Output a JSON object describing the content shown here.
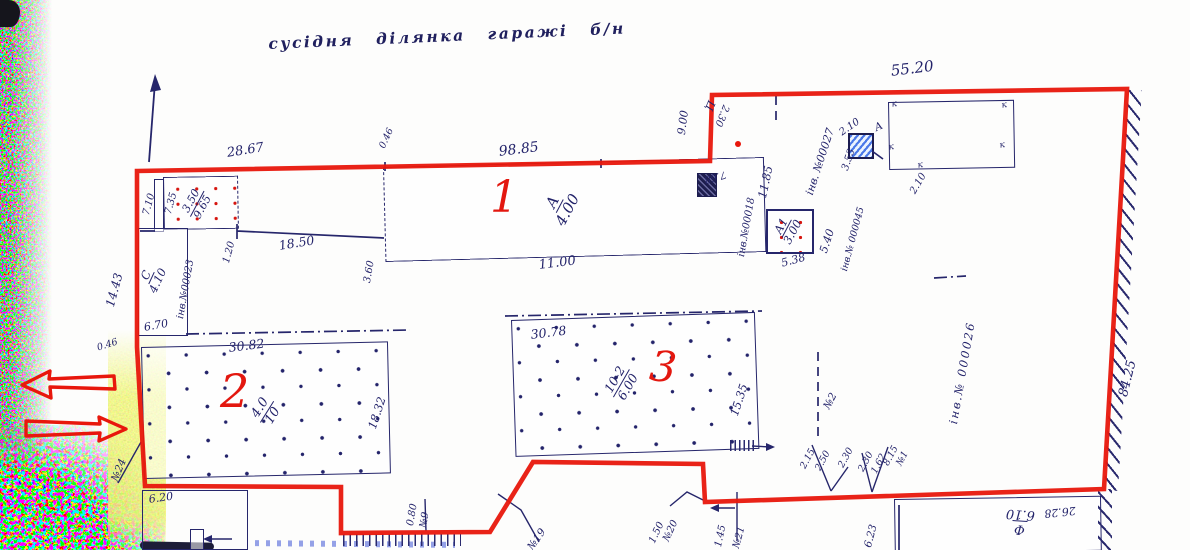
{
  "colors": {
    "boundary": "#e8170c",
    "ink": "#23236a",
    "red_label": "#e3170f"
  },
  "note": {
    "neighbor": "сусідня ділянка гаражі б/н"
  },
  "perimeter": {
    "top_left": "28.67",
    "top_gap": "0.46",
    "top_main": "98.85",
    "top_right": "55.20",
    "right_side": "84.25",
    "left_side": "14.43",
    "left_corner": "0.46",
    "notch": "9.00"
  },
  "row": {
    "len": "18.50",
    "gap": "1.20",
    "depth": "3.60",
    "small_top": "3.50",
    "small_bottom": "9.65",
    "side_out": "7.10",
    "side_in": "7.35"
  },
  "b1": {
    "num": "1",
    "lit": "А",
    "h": "4.00",
    "bottom": "11.00",
    "right": "11.85",
    "inv": "інв.№00018"
  },
  "bc": {
    "lit": "С",
    "h": "4.10",
    "inv": "інв.№00023",
    "bottom": "6.70"
  },
  "a1": {
    "lit": "А1",
    "h": "3.00",
    "right": "5.40",
    "bottom": "5.38",
    "inv": "інв.№ 000045"
  },
  "b2": {
    "num": "2",
    "top": "30.82",
    "side": "18.32",
    "lit": "4.0",
    "h": "10"
  },
  "b3": {
    "num": "3",
    "top": "30.78",
    "side": "15.35",
    "lit": "10-2",
    "h": "6.00"
  },
  "bf": {
    "lit": "Ф",
    "h": "6.10",
    "top": "26.28",
    "side": "6.23"
  },
  "shed": {
    "size": "6.20"
  },
  "tr": {
    "inv": "інв. №00027",
    "dim": "3.53",
    "roof": "2.10",
    "lit": "А",
    "wall": "2.10",
    "mark": "к",
    "flag": "Ц",
    "flag_h": "2.30",
    "small": "7.68"
  },
  "site": {
    "inv": "інв.№ 000026"
  },
  "pts": {
    "p1": "№1",
    "p2": "№2",
    "p9": "№9",
    "p9d": "0.80",
    "p19": "№19",
    "p20": "№20",
    "p20d": "1.50",
    "p21": "№21",
    "p21d": "1.45",
    "p24": "№24"
  },
  "off_l": [
    "2.15",
    "2.50",
    "2.30"
  ],
  "off_r": [
    "2.30",
    "1.62",
    "8.15"
  ]
}
